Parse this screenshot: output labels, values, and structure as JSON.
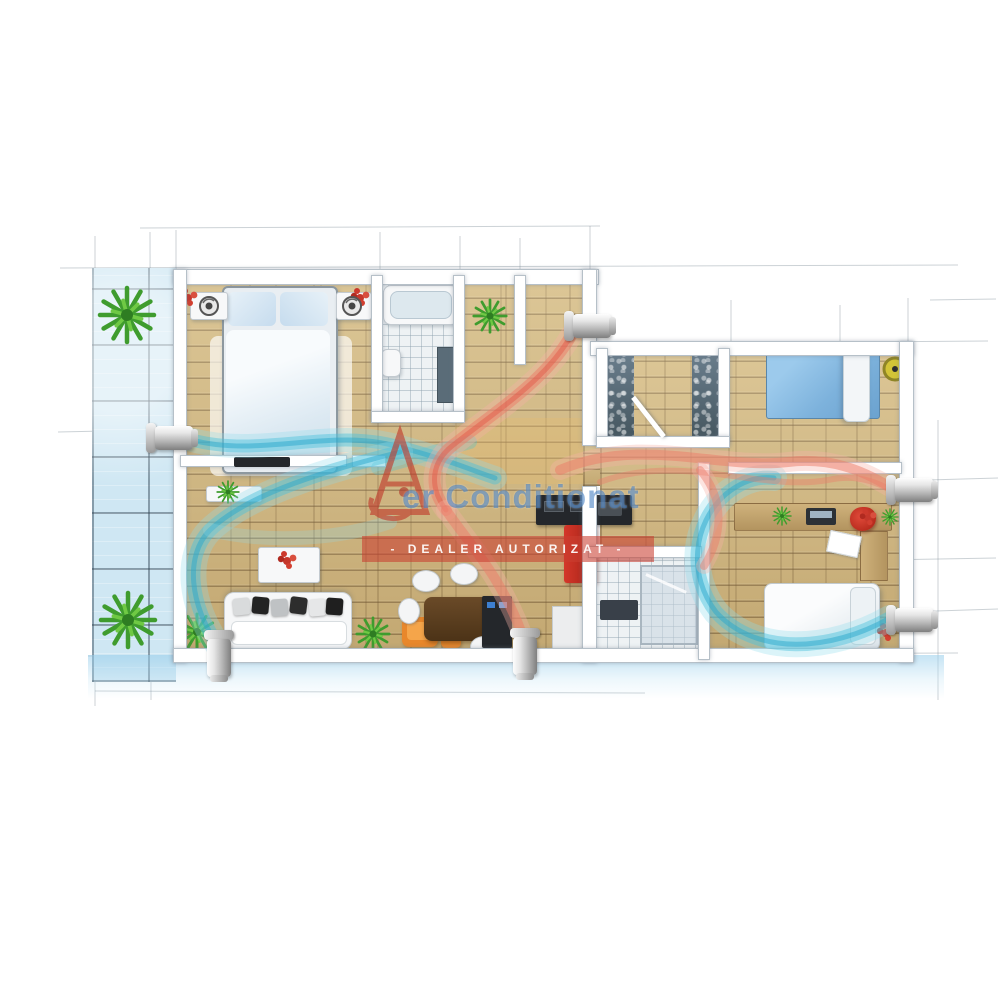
{
  "scene": {
    "type": "apartment-floorplan-3d-render",
    "style": "watercolor-sketch",
    "description": "Top-down 3D floor plan of an apartment with air-conditioning airflow visualization"
  },
  "watermark": {
    "brand_text": "er Conditionat",
    "brand_full": "Aer Conditionat",
    "badge_text": "- DEALER AUTORIZAT -",
    "brand_color": "#3876be",
    "badge_bg": "#ca3e30",
    "logo": "red-letter-A-compass-logo"
  },
  "airflows": [
    {
      "name": "cold-air-stream",
      "color": "#45bedd"
    },
    {
      "name": "warm-air-stream",
      "color": "#ea6f5e"
    }
  ],
  "ac_units": [
    {
      "name": "diffuser-left-wall",
      "orientation": "horizontal"
    },
    {
      "name": "diffuser-top-wall",
      "orientation": "horizontal"
    },
    {
      "name": "diffuser-right-wall-upper",
      "orientation": "horizontal"
    },
    {
      "name": "diffuser-right-wall-lower",
      "orientation": "horizontal"
    },
    {
      "name": "diffuser-bottom-wall-left",
      "orientation": "vertical"
    },
    {
      "name": "diffuser-bottom-wall-middle",
      "orientation": "vertical"
    }
  ],
  "rooms": [
    {
      "name": "terrace",
      "floor": "blue-tile",
      "items": [
        "plant",
        "plant"
      ]
    },
    {
      "name": "bedroom-1",
      "floor": "wood",
      "items": [
        "double-bed",
        "nightstand-left",
        "nightstand-right",
        "red-flowers",
        "fan"
      ]
    },
    {
      "name": "bathroom-1",
      "floor": "tile",
      "items": [
        "bathtub",
        "toilet",
        "shower"
      ]
    },
    {
      "name": "entry-hall",
      "floor": "wood",
      "items": [
        "plant"
      ]
    },
    {
      "name": "walk-in-closet",
      "floor": "wood",
      "items": [
        "wardrobe-left",
        "wardrobe-right",
        "door"
      ]
    },
    {
      "name": "bedroom-2",
      "floor": "wood",
      "items": [
        "single-bed-blue",
        "yellow-pouf"
      ]
    },
    {
      "name": "living-room",
      "floor": "wood",
      "items": [
        "sofa",
        "coffee-table",
        "tv-console",
        "orange-armchair",
        "ottoman",
        "plants"
      ]
    },
    {
      "name": "dining-kitchen",
      "floor": "wood",
      "items": [
        "dark-dining-table",
        "white-chairs",
        "kitchen-counter",
        "red-fridge",
        "island"
      ]
    },
    {
      "name": "bathroom-2",
      "floor": "tile",
      "items": [
        "shower-glass",
        "vanity"
      ]
    },
    {
      "name": "bedroom-3",
      "floor": "wood",
      "items": [
        "desk",
        "laptop",
        "red-desk-chair",
        "single-bed",
        "bench"
      ]
    }
  ],
  "palette": {
    "wood": "#cdb47e",
    "terrace_tile": "#cfe7f3",
    "wall": "#ffffff",
    "cold": "#45bedd",
    "warm": "#ea6f5e"
  }
}
